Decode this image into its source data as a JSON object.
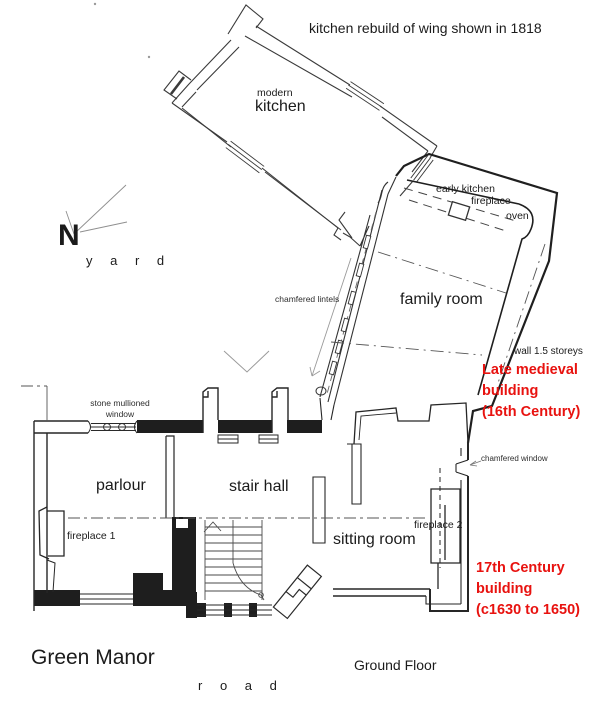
{
  "colors": {
    "ink": "#2a2a2a",
    "red": "#e8120f",
    "muted": "#8d8d8d"
  },
  "titles": {
    "name": "Green Manor",
    "floor": "Ground Floor"
  },
  "notes": {
    "rebuild": "kitchen rebuild of wing shown in 1818",
    "yard": "y a r d",
    "road": "r o a d",
    "north": "N"
  },
  "rooms": {
    "modern": "modern",
    "kitchen": "kitchen",
    "family": "family room",
    "parlour": "parlour",
    "stair_hall": "stair hall",
    "sitting": "sitting room"
  },
  "features": {
    "early_kitchen": "early kitchen",
    "early_fireplace": "fireplace",
    "oven": "oven",
    "chamfered_lintels": "chamfered lintels",
    "stone_window": "stone mullioned\nwindow",
    "fireplace1": "fireplace 1",
    "fireplace2": "fireplace 2",
    "chamfered_window": "chamfered window",
    "wall_storeys": "wall  1.5 storeys"
  },
  "periods": {
    "medieval": "Late medieval\nbuilding\n(16th Century)",
    "seventeenth": "17th Century\nbuilding\n(c1630 to 1650)"
  }
}
